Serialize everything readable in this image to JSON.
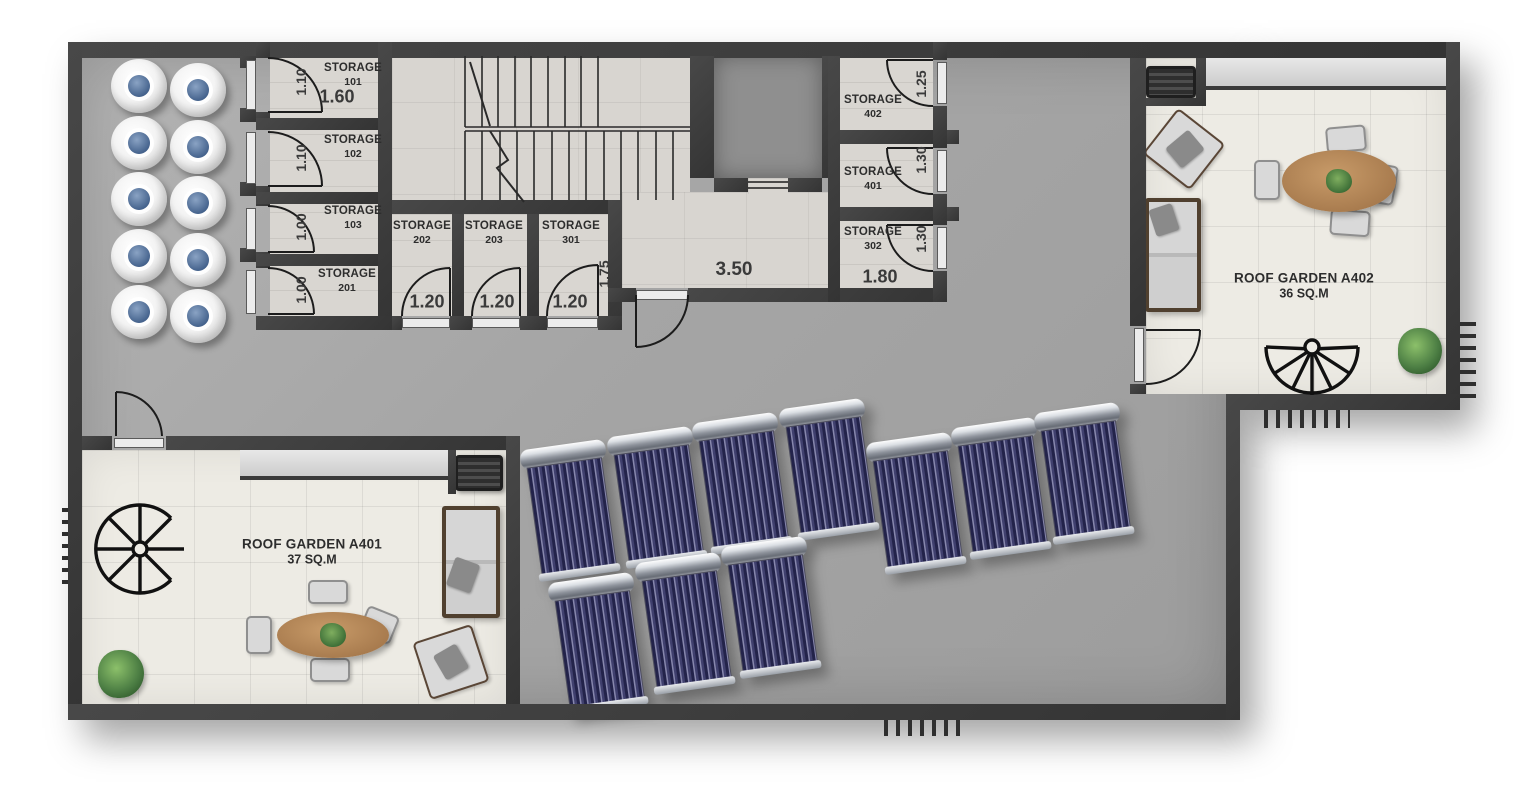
{
  "floor_plan": {
    "storage_rooms": [
      {
        "label": "STORAGE",
        "number": "101",
        "door_dim": "1.10",
        "width_dim": "1.60"
      },
      {
        "label": "STORAGE",
        "number": "102",
        "door_dim": "1.10"
      },
      {
        "label": "STORAGE",
        "number": "103",
        "door_dim": "1.00"
      },
      {
        "label": "STORAGE",
        "number": "201",
        "door_dim": "1.00"
      },
      {
        "label": "STORAGE",
        "number": "202",
        "door_dim": "1.20"
      },
      {
        "label": "STORAGE",
        "number": "203",
        "door_dim": "1.20"
      },
      {
        "label": "STORAGE",
        "number": "301",
        "door_dim": "1.20",
        "depth_dim": "1.75"
      },
      {
        "label": "STORAGE",
        "number": "402",
        "door_dim": "1.25"
      },
      {
        "label": "STORAGE",
        "number": "401",
        "door_dim": "1.30"
      },
      {
        "label": "STORAGE",
        "number": "302",
        "door_dim": "1.30",
        "width_dim": "1.80"
      }
    ],
    "corridor": {
      "width_dim": "3.50"
    },
    "roof_gardens": [
      {
        "name": "ROOF GARDEN A401",
        "area": "37 SQ.M"
      },
      {
        "name": "ROOF GARDEN A402",
        "area": "36 SQ.M"
      }
    ],
    "equipment": {
      "water_tanks": 10,
      "solar_collectors": 10
    },
    "colors": {
      "wall": "#3c3c3c",
      "deck": "#a8a8a8",
      "garden_tile": "#edebe4",
      "room_floor": "#d8d5d0",
      "solar_blue": "#40406e",
      "tank_cap_blue": "#46648e"
    }
  }
}
